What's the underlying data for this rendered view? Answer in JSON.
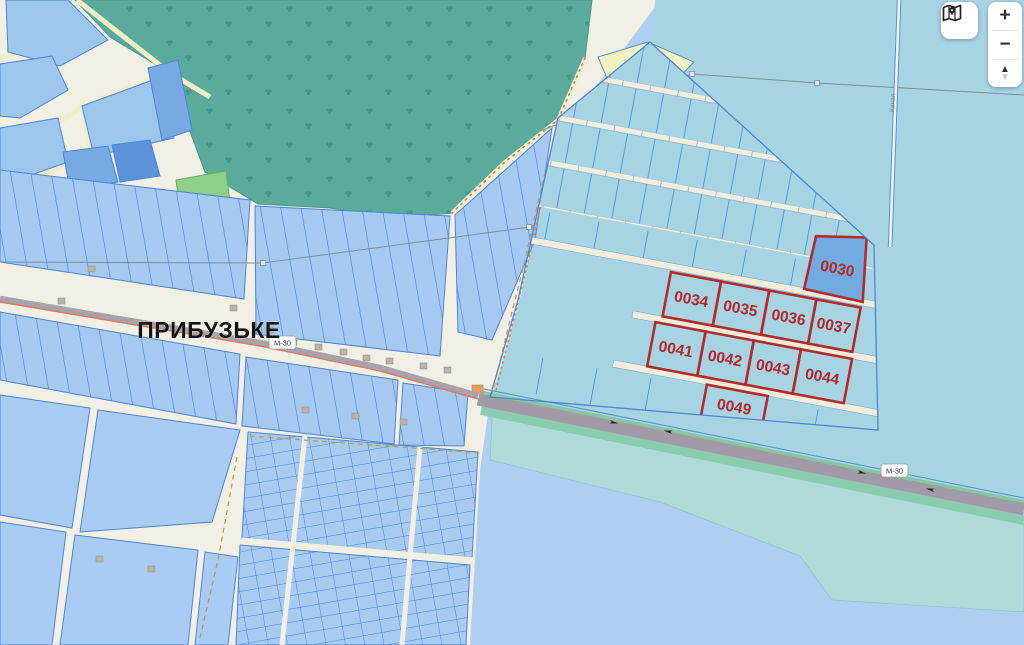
{
  "map": {
    "place_label": "ПРИБУЗЬКЕ",
    "road_shield": "М-30",
    "canal_label": "Канал",
    "red_parcels": {
      "items": [
        {
          "id": "0030"
        },
        {
          "id": "0034"
        },
        {
          "id": "0035"
        },
        {
          "id": "0036"
        },
        {
          "id": "0037"
        },
        {
          "id": "0041"
        },
        {
          "id": "0042"
        },
        {
          "id": "0043"
        },
        {
          "id": "0044"
        },
        {
          "id": "0049"
        }
      ]
    },
    "colors": {
      "highlight_parcel_border": "#b52b2b",
      "highlight_parcel_label": "#b8262b",
      "special_parcel_fill": "#72abdf",
      "village_parcel_fill": "#a6c9f1",
      "village_parcel_stroke": "#4f84da",
      "field_fill": "#a7d4e3",
      "forest_fill": "#5bab9c",
      "water_bottom_fill": "#aecff2",
      "road_cream": "#f1eedb",
      "highway_gray": "#a29aa6",
      "highway_green": "#84c7a1"
    }
  },
  "controls": {
    "map_style_icon": "map-pin-icon",
    "zoom_in_label": "+",
    "zoom_out_label": "−",
    "tilt_up_icon": "▲",
    "tilt_down_icon": "▼"
  }
}
